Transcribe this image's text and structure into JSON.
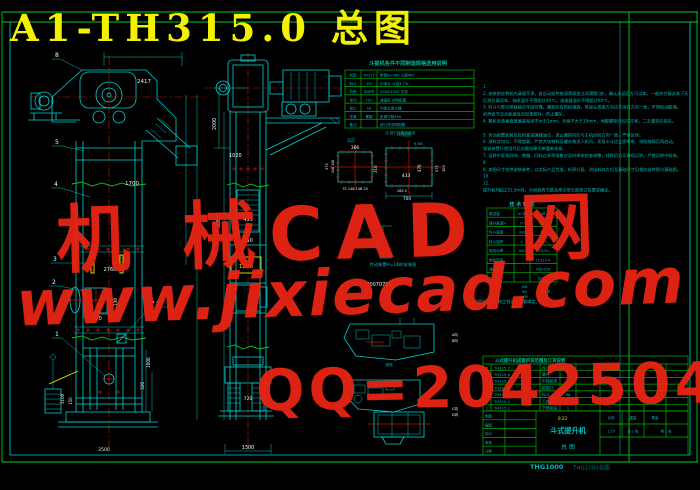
{
  "title": "A1-TH315.0 总图",
  "watermark": {
    "line1": "机 械CAD 网",
    "line2": "www.jixiecad.com",
    "line3": "QQ=20425042",
    "color": "#e82413"
  },
  "frame": {
    "footer_code": "THG1000",
    "footer_name": "THG1000总图"
  },
  "left_view": {
    "balloon_8": "8",
    "balloon_5": "5",
    "balloon_4": "4",
    "balloon_3": "3",
    "balloon_2": "2",
    "balloon_1": "1",
    "balloon_7_9": "7 9",
    "dim_2417": "2417",
    "dim_1700": "1700",
    "dim_2760": "2760",
    "dim_430": "430",
    "dim_130": "130",
    "dim_1000": "1000",
    "dim_320": "320",
    "dim_3100": "3100",
    "dim_150": "150",
    "dim_2500": "2500"
  },
  "mid_view": {
    "dim_2000": "2000",
    "dim_1020": "1020",
    "dim_30800": "30800",
    "dim_455": "455",
    "dim_950": "950",
    "tag_1200": "1200",
    "dim_720": "720",
    "dim_1300": "1300",
    "dim_375": "375",
    "dim_148": "148 148"
  },
  "details": {
    "label_a": "E向",
    "label_b": "I向视图",
    "label_6m8": "6-M8",
    "a_top": "366",
    "a_right": "316",
    "a_bottom": "75 148 148 25",
    "b_width": "433",
    "b_diag": "476",
    "b_right": "575",
    "b_far": "300",
    "b_bottom": "282.5",
    "b_bottom2": "700",
    "dim_1480": "1480",
    "caption_drive": "传动装置H=1480安装图",
    "dim_700s": "70070700"
  },
  "plan_views": {
    "label_1": "A向",
    "label_2": "B向",
    "label_3": "C向",
    "label_4": "D向",
    "caption": "俯视"
  },
  "spec_table": {
    "caption": "斗提机各件不同制造规格选用说明",
    "note": "注:按订货要求选用",
    "rows": [
      [
        "机型",
        "TH315",
        "带宽B=400 斗距480"
      ],
      [
        "料斗",
        "ZD",
        "中深斗 斗容3.75L"
      ],
      [
        "机壳",
        "中间节",
        "2000/1000 可选"
      ],
      [
        "传动",
        "YZC",
        "减速机 外购配套"
      ],
      [
        "逆止",
        "NJ",
        "内装式逆止器"
      ],
      [
        "张紧",
        "螺旋",
        "张紧行程450"
      ],
      [
        "备注",
        "",
        "按订货说明配置"
      ]
    ]
  },
  "notes": {
    "lines": [
      "1.",
      "2. 安装前应将机内清理干净，各运动部件按润滑表加注润滑脂(油)，确认无误后方可试车。一般先空载试车 7天",
      "   后再负载试车，轴承温升不得超过40℃，减速器温升不得超过60℃。",
      "3. 料斗与牵引带联接应牢固可靠，螺栓应有防松措施，带接头搭接方向应与运行方向一致，不得松动脱落。",
      "   机壳各节法兰联接处应加垫密封，防止漏灰。",
      "4. 整机安装垂直度偏差每米不大于1mm，全高不大于10mm，地脚螺栓应均匀拧紧，二次灌浆应捣实。",
      "",
      "5. 传动装置安装后应检查减速器油位，逆止器转向应与主机运转方向一致，严禁反转。",
      "6. 进料应均匀，不得超载，严禁大块物料及硬杂物进入机内，发现卡斗应立即停车，排除故障后再启动。",
      "   张紧装置行程用尽后应截短牵引带重新张紧。",
      "7. 运转中发现异响、跑偏、回料过多等现象应及时停车检查调整，排除后方可继续运转，严禁运转中检修。",
      "8.",
      "9. 本图尺寸仅供安装参考，以实际产品为准，机壳分段、进出料口方位及基础尺寸见相应部件图与基础图。",
      "10.",
      "11.",
      "   提升机H超过31.5m时，中间机壳节数及牵引带长度按订货要求确定。"
    ]
  },
  "tech_table": {
    "title": "技 术 特 性",
    "rows": [
      [
        "输送量",
        "m³/h",
        "28"
      ],
      [
        "提升高度H",
        "m",
        "31.5"
      ],
      [
        "料斗速度",
        "m/s",
        "1.4"
      ],
      [
        "料斗容积",
        "L",
        "3.75"
      ],
      [
        "电机功率",
        "kW",
        "2×3 H="
      ],
      [
        "电机型号",
        "",
        "Y132S-4"
      ],
      [
        "减速器",
        "",
        "450/315"
      ],
      [
        "逆止器",
        "",
        "内装式"
      ]
    ],
    "unit_kw": "KW",
    "unit_kn": "KN",
    "unit_mm": "MM",
    "value_1000": "1000",
    "note": "(3)提升高度H按工程设计需要确定。"
  },
  "parts_table": {
    "caption": "斗式提升机成套供货范围及订货说明",
    "rows": [
      [
        "7",
        "TH315.7",
        "传动装置",
        "1"
      ],
      [
        "6",
        "TH315.6",
        "罩壳",
        "1"
      ],
      [
        "5",
        "TH315.5",
        "中部机壳",
        "n"
      ],
      [
        "4",
        "TH315.4",
        "检视门",
        "2"
      ],
      [
        "3",
        "TH315.3",
        "料斗",
        "86"
      ],
      [
        "2",
        "TH315.2",
        "上部区段",
        "1"
      ],
      [
        "1",
        "TH315.1",
        "下部区段",
        "1"
      ]
    ]
  },
  "title_block": {
    "name1": "斗式提升机",
    "name2": "总 图",
    "tag": "0.23",
    "row_labels": [
      "制图",
      "描图",
      "校对",
      "审核",
      "日期"
    ],
    "scale_label": "比例",
    "scale": "1:25",
    "weight_label": "重量",
    "qty_label": "数量",
    "sheet1": "共 1 张",
    "sheet2": "第 1 张"
  }
}
